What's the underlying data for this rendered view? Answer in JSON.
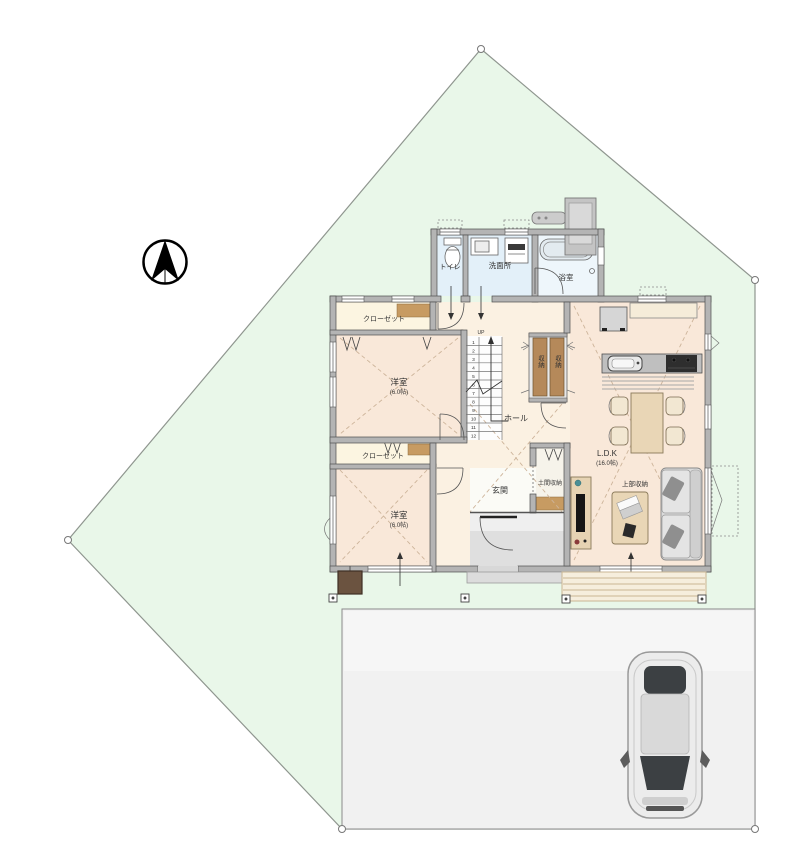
{
  "title": "1F間取り図・敷地配置図",
  "colors": {
    "site_fill": "#e9f7e9",
    "site_stroke": "#8f968f",
    "parking_fill": "#f1f1f1",
    "wall_fill": "#b4b4b4",
    "floor_bedroom": "#f9e8d9",
    "floor_hall": "#fbf1e2",
    "floor_closet": "#fcf5e1",
    "floor_wet": "#e3f0f9",
    "floor_bath": "#eef6fb",
    "floor_entrance": "#fbfbf6",
    "floor_tile": "#dfdfdf",
    "storage_brown": "#b5895a",
    "furniture_tan": "#e9d6b6",
    "sofa_gray": "#dcdcdc",
    "deck_tan": "#f6eedd",
    "label_tan": "#c9a478",
    "car_body": "#ececec"
  },
  "labels": {
    "toilet": "トイレ",
    "washroom": "洗面所",
    "bath": "浴室",
    "closet1": "クローゼット",
    "closet2": "クローゼット",
    "bedroom1": "洋室",
    "bedroom1_size": "(6.0帖)",
    "bedroom2": "洋室",
    "bedroom2_size": "(6.0帖)",
    "hall": "ホール",
    "storage_a": "収納",
    "storage_b": "収納",
    "entrance": "玄関",
    "doma_storage": "土間収納",
    "ldk": "L.D.K",
    "ldk_size": "(16.0帖)",
    "upper_storage": "上部収納"
  },
  "stairs": {
    "up": "UP",
    "steps": [
      "1",
      "2",
      "3",
      "4",
      "5",
      "6",
      "7",
      "8",
      "9",
      "10",
      "11",
      "12"
    ]
  }
}
